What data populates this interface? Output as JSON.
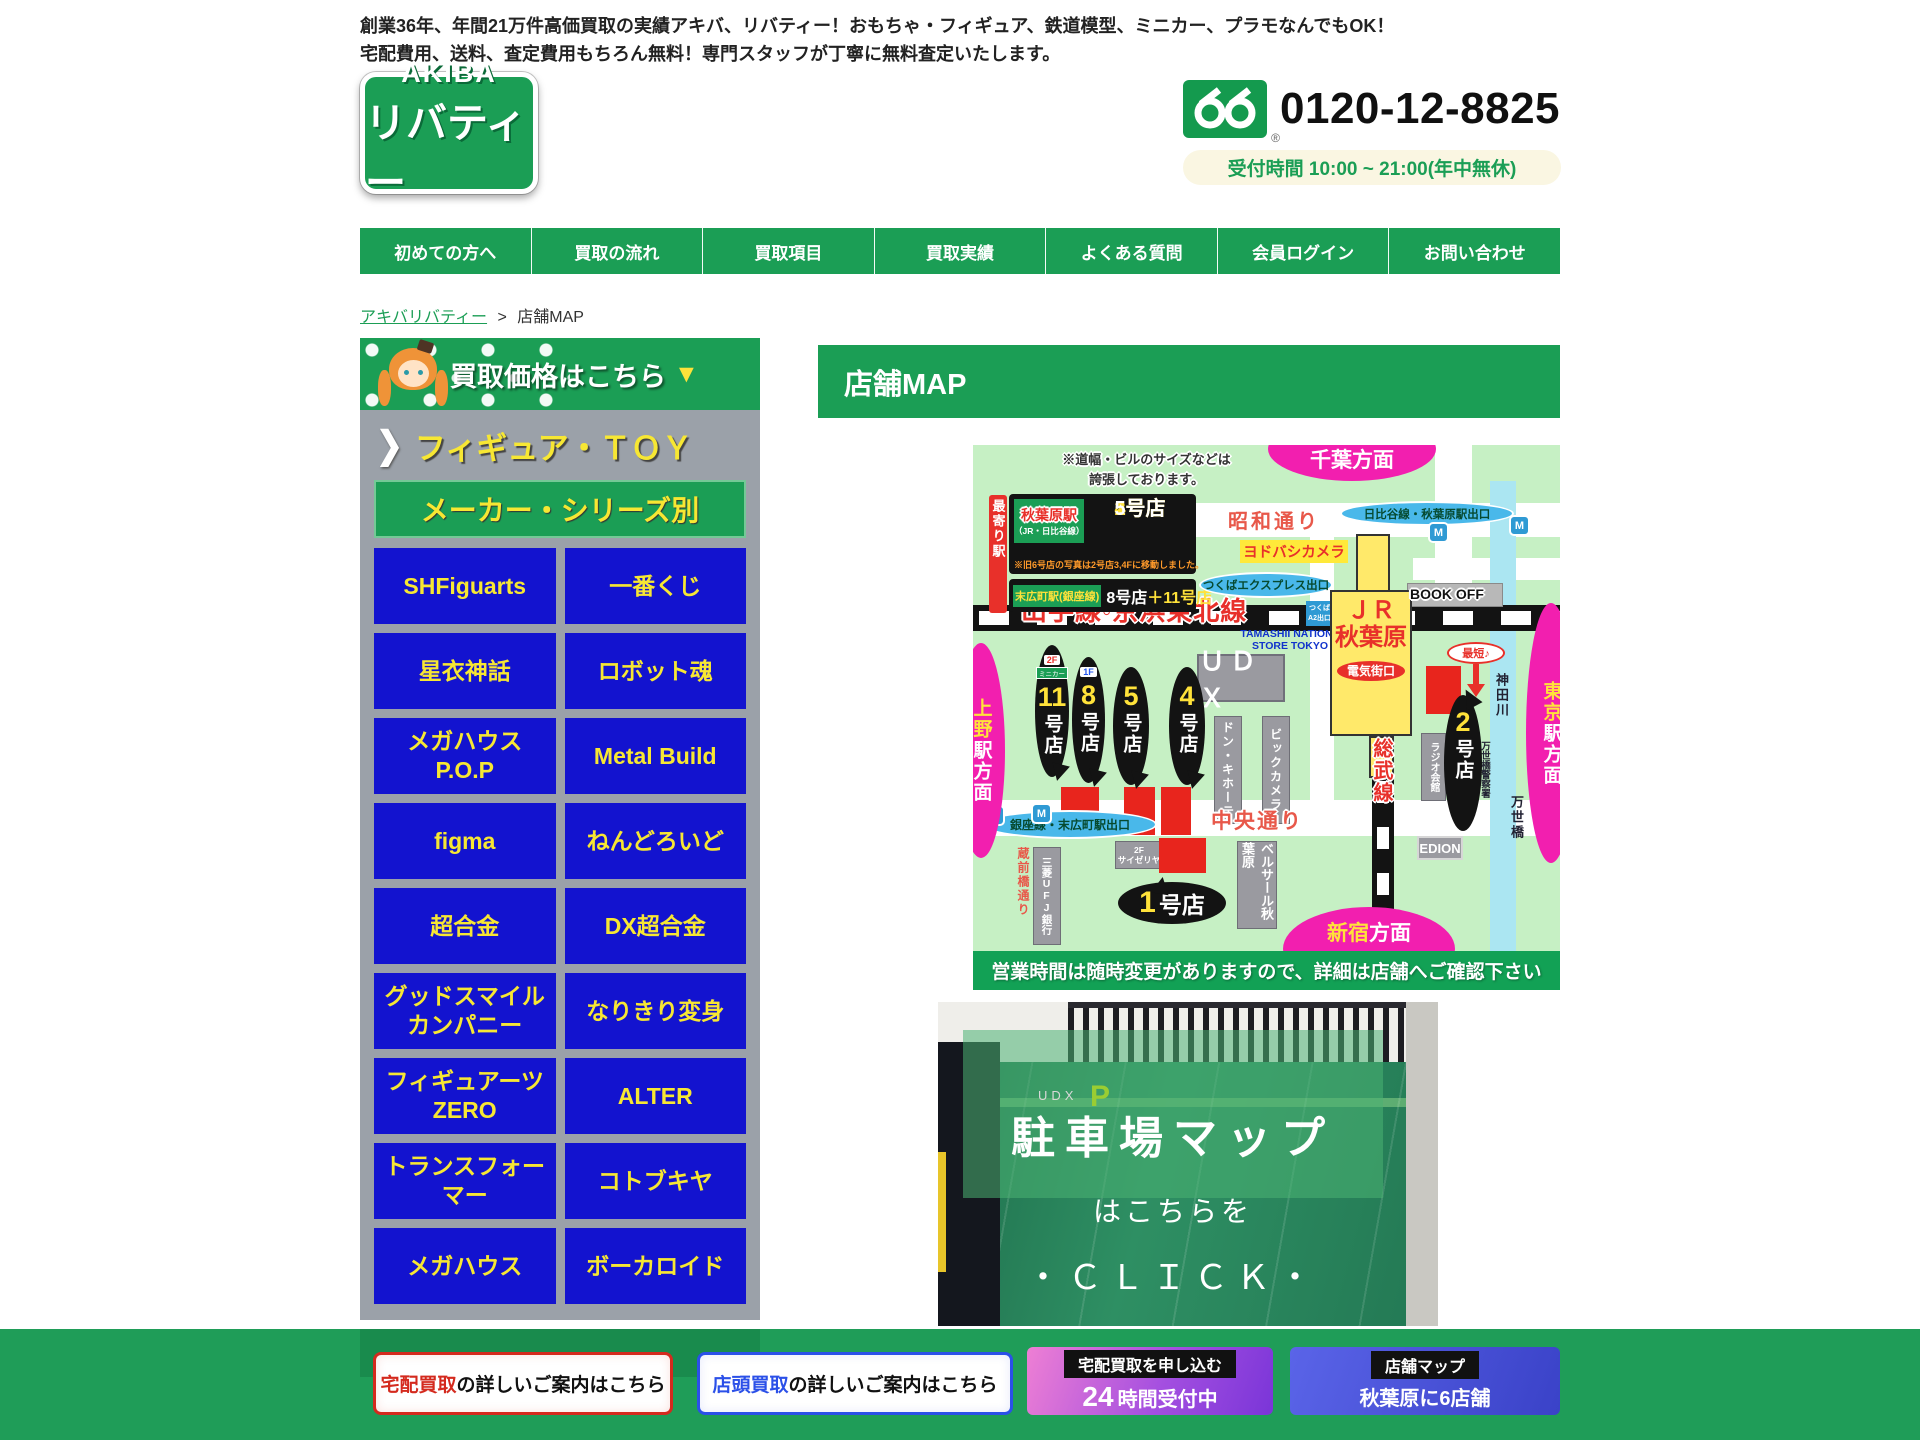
{
  "header": {
    "tagline_line1": "創業36年、年間21万件高価買取の実績アキバ、リバティー！おもちゃ・フィギュア、鉄道模型、ミニカー、プラモなんでもOK！",
    "tagline_line2": "宅配費用、送料、査定費用もちろん無料！専門スタッフが丁寧に無料査定いたします。",
    "logo_top": "AKIBA",
    "logo_bottom": "リバティー",
    "freedial_mark": "®",
    "phone_number": "0120-12-8825",
    "hours": "受付時間 10:00 ~ 21:00(年中無休)"
  },
  "nav": {
    "items": [
      "初めての方へ",
      "買取の流れ",
      "買取項目",
      "買取実績",
      "よくある質問",
      "会員ログイン",
      "お問い合わせ"
    ]
  },
  "breadcrumb": {
    "home": "アキバリバティー",
    "separator": ">",
    "current": "店舗MAP"
  },
  "sidebar": {
    "banner_title": "買取価格はこちら",
    "banner_arrow": "▼",
    "section_chevron": "❯",
    "section_figure_toy": "フィギュア・ＴＯＹ",
    "section_maker": "メーカー・シリーズ別",
    "categories": [
      "SHFiguarts",
      "一番くじ",
      "星衣神話",
      "ロボット魂",
      "メガハウス P.O.P",
      "Metal Build",
      "figma",
      "ねんどろいど",
      "超合金",
      "DX超合金",
      "グッドスマイルカンパニー",
      "なりきり変身",
      "フィギュアーツZERO",
      "ALTER",
      "トランスフォーマー",
      "コトブキヤ",
      "メガハウス",
      "ボーカロイド"
    ]
  },
  "main": {
    "page_title": "店舗MAP"
  },
  "map": {
    "note_line1": "※道幅・ビルのサイズなどは",
    "note_line2": "誇張しております。",
    "dir_chiba": "千葉方面",
    "nearest_station": "最寄り駅",
    "akihabara_station": "秋葉原駅",
    "akihabara_lines": "（JR・日比谷線）",
    "store1": "1号店",
    "store2": "2号店",
    "store4": "4号店",
    "store5": "5号店",
    "moved_note": "※旧6号店の写真は2号店3,4Fに移動しました。",
    "suehirocho_station": "末広町駅(銀座線)",
    "store8": "8号店",
    "store11_plus": "＋11号店",
    "showa_dori": "昭和通り",
    "yodobashi": "ヨドバシカメラ",
    "hibiya_exit": "日比谷線・秋葉原駅出口",
    "tsukuba_exit": "つくばエクスプレス出口",
    "a2_line1": "つくば",
    "a2_line2": "A2出口",
    "jr_line1": "ＪＲ",
    "jr_line2": "秋葉原",
    "denkigai": "電気街口",
    "bookoff": "BOOK OFF",
    "yamanote": "山手線◦京浜東北線",
    "tamashii1": "TAMASHII NATIONS",
    "tamashii2": "STORE TOKYO",
    "udx": "ＵＤＸ",
    "donki": "ドン・キホーテ",
    "bic": "ビックカメラ",
    "radio": "ラジオ会館",
    "kanda_river": "神田川",
    "police": "万世橋警察署",
    "manseibashi": "万世橋",
    "ueno_main": "上野",
    "ueno_suffix": "駅方面",
    "tokyo_main": "東京",
    "tokyo_suffix": "駅方面",
    "shinjuku_main": "新宿",
    "shinjuku_suffix": "方面",
    "chuo_dori": "中央通り",
    "ginza_exit": "銀座線・末広町駅出口",
    "kuramae": "蔵前橋通り",
    "ufj": "三菱UFJ銀行",
    "saizeriya_floor": "2F",
    "saizeriya": "サイゼリヤ",
    "bellesalle": "ベルサール秋葉原",
    "edion": "EDION",
    "sobu": "総武線",
    "shortest": "最短♪",
    "metro": "M",
    "balloons": {
      "b11": {
        "badge": "2F",
        "badge2": "ミニカー",
        "num": "11",
        "suffix": "号店"
      },
      "b8": {
        "badge": "1F",
        "num": "8",
        "suffix": "号店"
      },
      "b5": {
        "num": "5",
        "suffix": "号店"
      },
      "b4": {
        "num": "4",
        "suffix": "号店"
      },
      "b2": {
        "num": "2",
        "suffix": "号店"
      },
      "b1": {
        "num": "1",
        "suffix": "号店"
      }
    },
    "info_bar": "営業時間は随時変更がありますので、詳細は店舗へご確認下さい"
  },
  "parking": {
    "sign_udx": "UDX",
    "sign_p": "P",
    "title": "駐車場マップ",
    "line2": "はこちらを",
    "line3": "・ＣＬＩＣＫ・"
  },
  "footer": {
    "btn1_em": "宅配買取",
    "btn1_rest": "の詳しいご案内はこちら",
    "btn2_em": "店頭買取",
    "btn2_rest": "の詳しいご案内はこちら",
    "btn3_label": "宅配買取を申し込む",
    "btn3_num": "24",
    "btn3_rest": "時間受付中",
    "btn4_label": "店舗マップ",
    "btn4_sub": "秋葉原に6店舗"
  },
  "colors": {
    "brand_green": "#1b9e55",
    "sidebar_blue": "#1313cf",
    "accent_yellow": "#f7e733",
    "map_pink": "#f21faf",
    "map_light_green": "#c6f0c4",
    "exit_bubble_blue": "#49b8ea",
    "alert_red": "#e8302a"
  }
}
